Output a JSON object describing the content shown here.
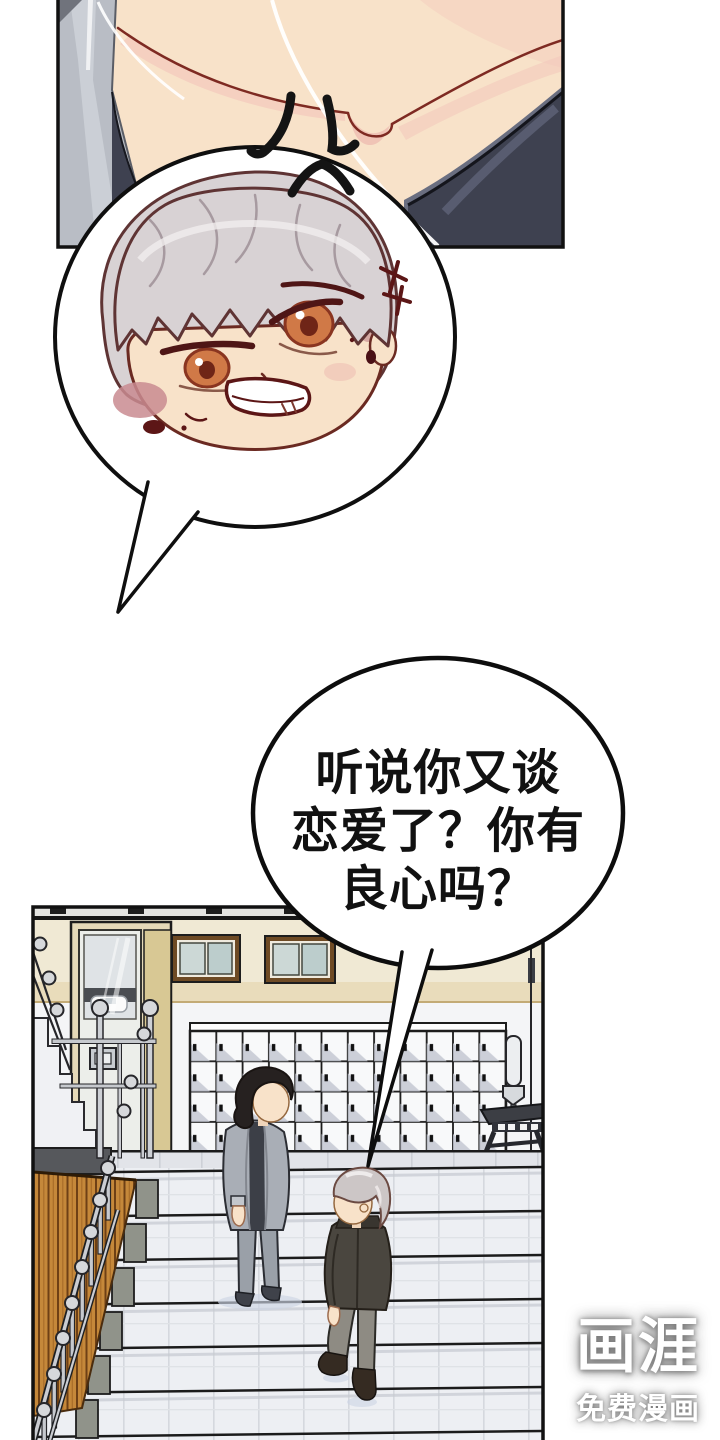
{
  "page": {
    "kind": "webtoon comic page",
    "background": "#ffffff"
  },
  "speech_bubble": {
    "lines": [
      "听说你又谈",
      "恋爱了？你有",
      "良心吗？"
    ]
  },
  "watermark": {
    "logo": "画涯",
    "tagline": "免费漫画"
  },
  "palette": {
    "skin": "#f8e2c9",
    "skin_shade_pink": "#f3c9bc",
    "outline_maroon": "#6b2a22",
    "clothing_navy": "#3e4150",
    "chibi_hair_grey": "#d8d2d4",
    "wall_cream": "#f0e9d4",
    "wall_beige": "#e9dcbb",
    "window_frame_brown": "#6e4a24",
    "locker_white": "#f8f9fa",
    "wood_orange": "#c5883a",
    "stair_tile": "#edeff3",
    "cardigan_grey": "#a9aeb6",
    "jacket_dark": "#4a463f",
    "silver_hair": "#ccc6c6"
  }
}
